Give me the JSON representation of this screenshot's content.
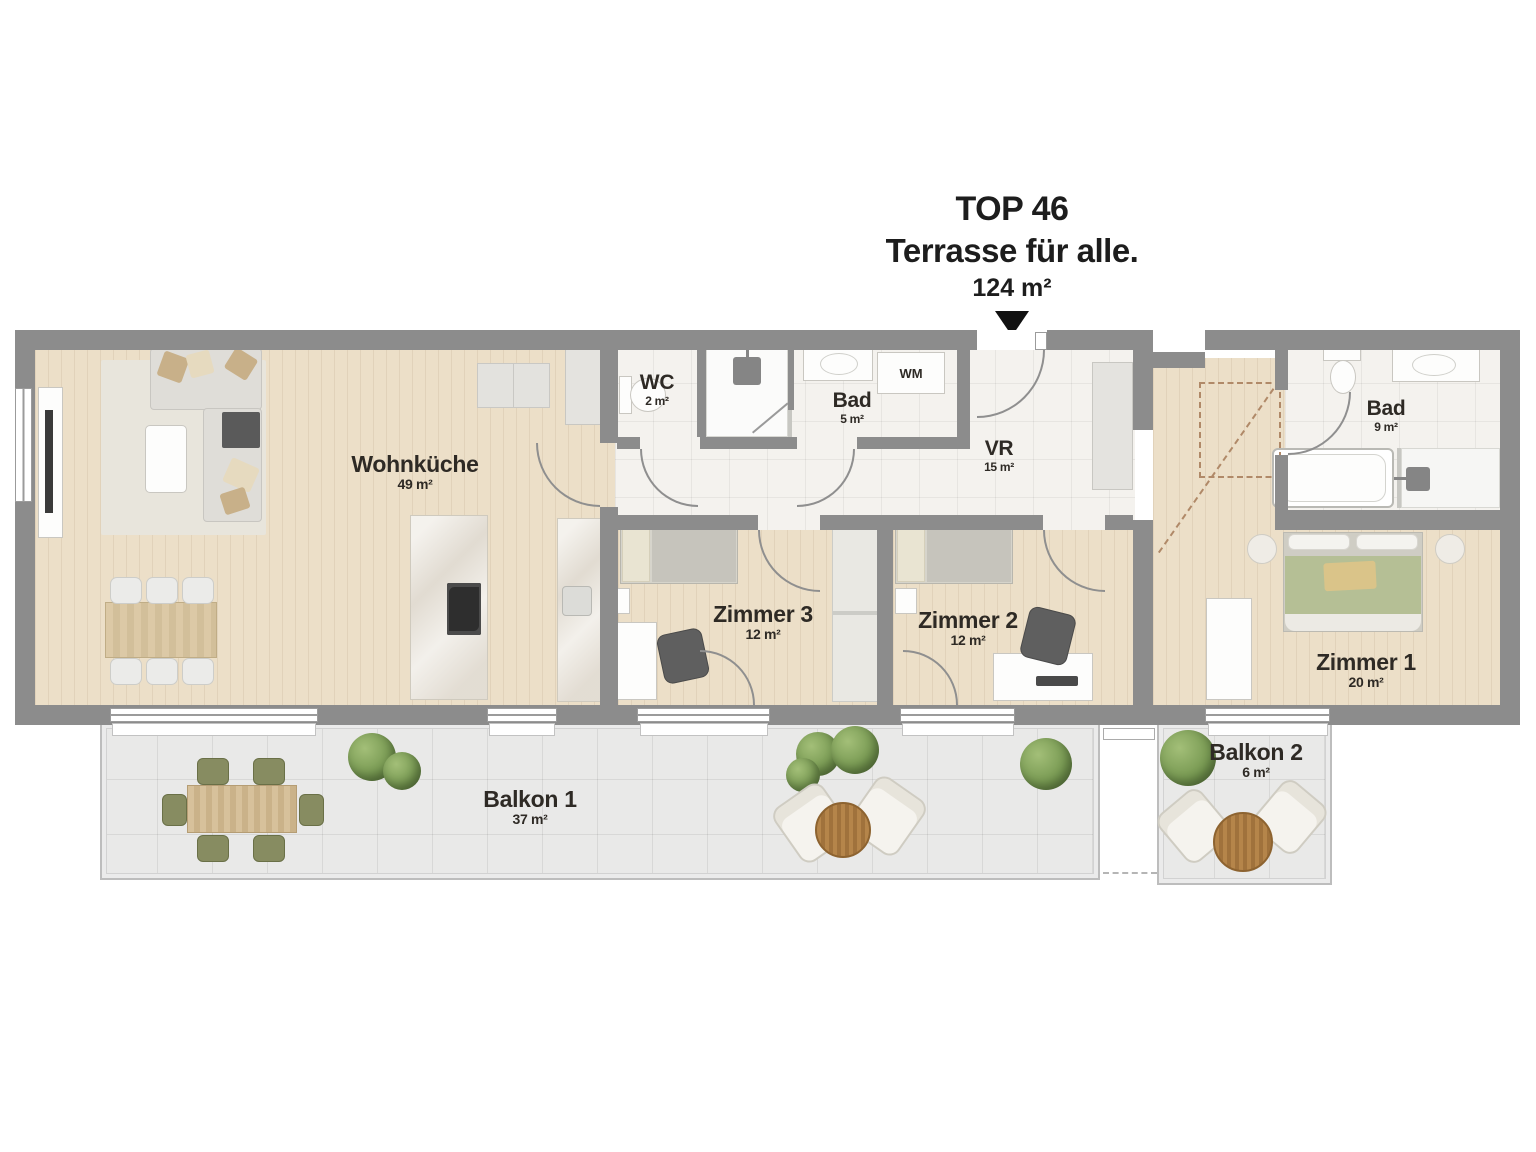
{
  "title": {
    "top_line": "TOP 46",
    "subtitle": "Terrasse für alle.",
    "total_area": "124 m²"
  },
  "rooms": [
    {
      "id": "wohnkueche",
      "name": "Wohnküche",
      "area": "49 m²"
    },
    {
      "id": "wc",
      "name": "WC",
      "area": "2 m²"
    },
    {
      "id": "bad-klein",
      "name": "Bad",
      "area": "5 m²"
    },
    {
      "id": "vr",
      "name": "VR",
      "area": "15 m²"
    },
    {
      "id": "bad-gross",
      "name": "Bad",
      "area": "9 m²"
    },
    {
      "id": "zimmer3",
      "name": "Zimmer 3",
      "area": "12 m²"
    },
    {
      "id": "zimmer2",
      "name": "Zimmer 2",
      "area": "12 m²"
    },
    {
      "id": "zimmer1",
      "name": "Zimmer 1",
      "area": "20 m²"
    },
    {
      "id": "balkon1",
      "name": "Balkon 1",
      "area": "37 m²"
    },
    {
      "id": "balkon2",
      "name": "Balkon 2",
      "area": "6 m²"
    }
  ],
  "appliances": {
    "washing_machine_label": "WM"
  },
  "colors": {
    "wall": "#8c8c8c",
    "wood_floor": "#ecdfc8",
    "tile_floor": "#f4f2ee",
    "balcony_floor": "#e9e9e8",
    "plant_green": "#74964f",
    "label_text": "#2e2a25"
  }
}
